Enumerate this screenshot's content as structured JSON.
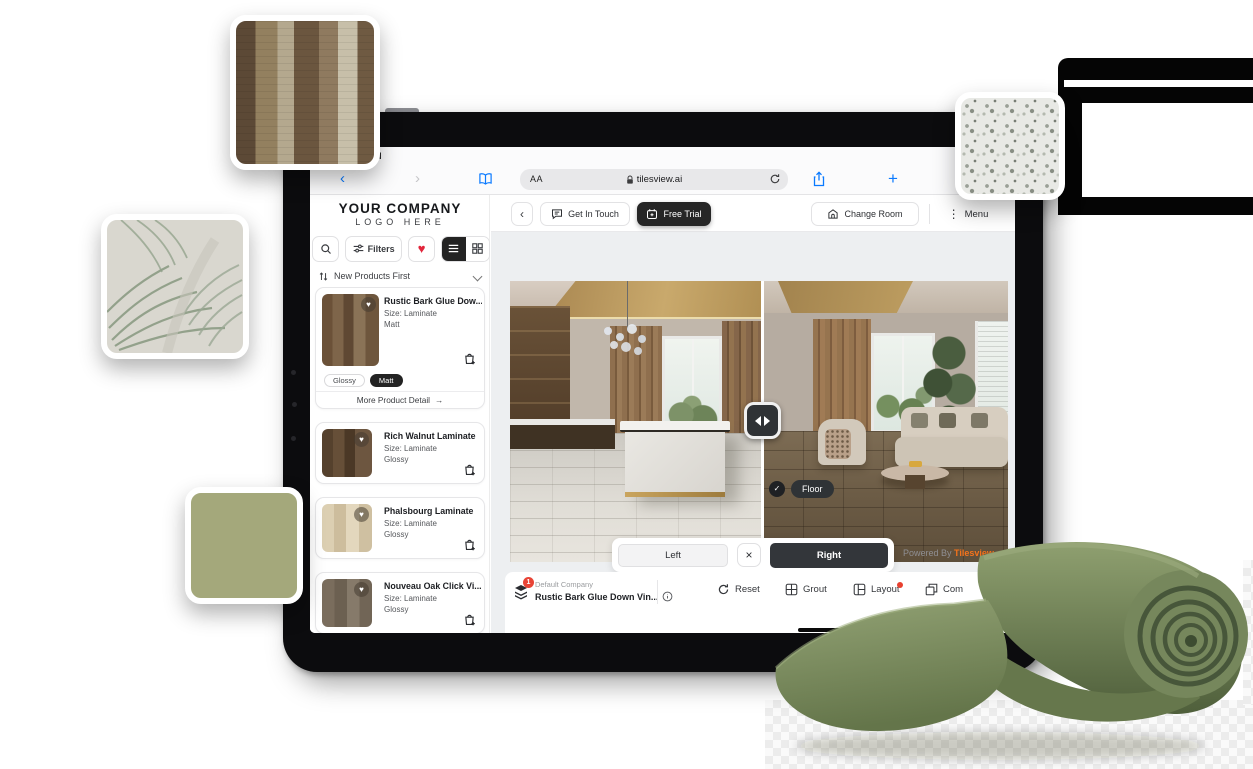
{
  "status": {
    "time_partial": "M"
  },
  "browser": {
    "reader_button": "AA",
    "url": "tilesview.ai"
  },
  "app": {
    "logo": {
      "line1": "YOUR COMPANY",
      "line2": "LOGO HERE"
    },
    "header": {
      "get_in_touch": "Get In Touch",
      "free_trial": "Free Trial",
      "change_room": "Change Room",
      "menu": "Menu"
    },
    "sidebar": {
      "filters": "Filters",
      "sort": "New Products First",
      "finish_glossy": "Glossy",
      "finish_matt": "Matt",
      "more_detail": "More Product Detail",
      "products": [
        {
          "name": "Rustic Bark Glue Dow...",
          "size": "Size: Laminate",
          "finish": "Matt"
        },
        {
          "name": "Rich Walnut Laminate",
          "size": "Size: Laminate",
          "finish": "Glossy"
        },
        {
          "name": "Phalsbourg Laminate",
          "size": "Size: Laminate",
          "finish": "Glossy"
        },
        {
          "name": "Nouveau Oak Click Vi...",
          "size": "Size: Laminate",
          "finish": "Glossy"
        },
        {
          "name": "Meadow Laminate",
          "size": "Size: Laminate",
          "finish": ""
        }
      ]
    },
    "viewer": {
      "floor_badge": "Floor",
      "left": "Left",
      "right": "Right",
      "powered_by": "Powered By",
      "brand": "Tilesview"
    },
    "toolbar": {
      "badge": "1",
      "company": "Default Company",
      "selected_product": "Rustic Bark Glue Down Vin...",
      "reset": "Reset",
      "grout": "Grout",
      "layout": "Layout",
      "compare": "Com"
    }
  },
  "icons": {
    "heart": "♥",
    "kebab": "⋮",
    "back": "‹",
    "forward": "›",
    "close": "×",
    "check": "✓",
    "arrow_right": "→",
    "plus": "+"
  },
  "colors": {
    "brand_orange": "#f4731c",
    "active_dark": "#2f3235",
    "heart_red": "#e2263c",
    "badge_red": "#e84436",
    "ios_blue": "#0a7aff",
    "swatch_green": "#a4a87b",
    "carpet_green": "#76875c"
  }
}
